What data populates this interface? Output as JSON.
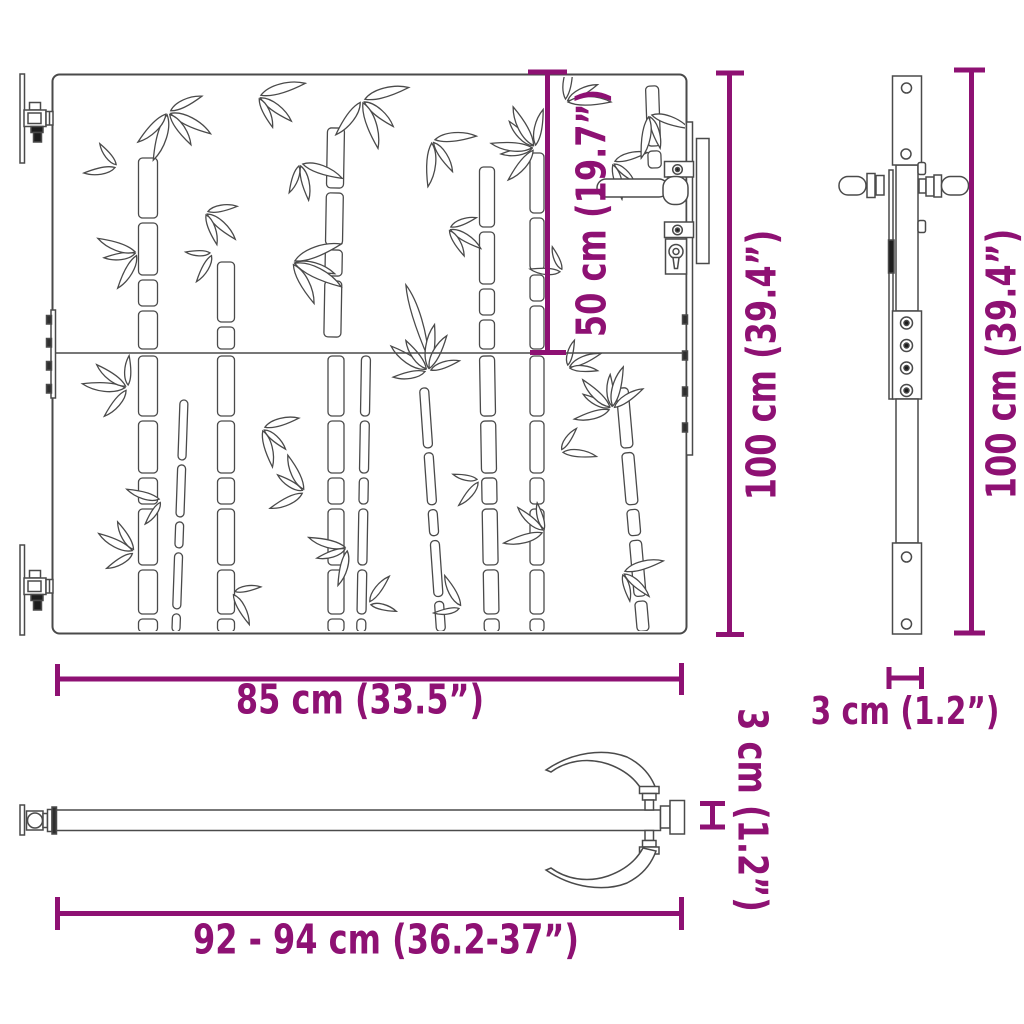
{
  "colors": {
    "accent": "#8E1173",
    "line": "#4a4a4a"
  },
  "views": {
    "front": {
      "panel_height_label": "50 cm (19.7”)",
      "height_label": "100 cm (39.4”)",
      "width_label": "85 cm (33.5”)"
    },
    "side": {
      "height_label": "100 cm (39.4”)",
      "depth_label": "3 cm (1.2”)"
    },
    "bottom": {
      "thickness_label": "3 cm (1.2”)",
      "total_width_label": "92 - 94 cm (36.2-37”)"
    }
  }
}
